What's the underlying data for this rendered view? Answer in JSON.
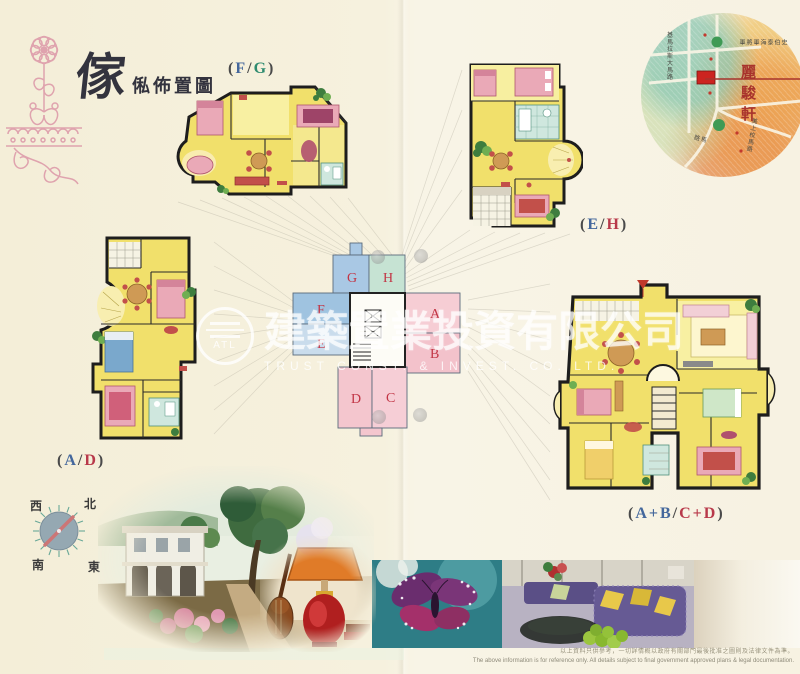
{
  "header": {
    "title_main": "傢",
    "title_sub": "俬佈置圖"
  },
  "location_map": {
    "name": "麗駿軒",
    "street_top": "基馬拉斯大馬路",
    "street_vertical": "史伯泰海軍將軍",
    "street_right": "美上校馬路",
    "street_diag": "馬路"
  },
  "floor_plans": {
    "fg": {
      "prefix": "(",
      "a": "F",
      "sep": "/",
      "b": "G",
      "suffix": ")"
    },
    "eh": {
      "prefix": "(",
      "a": "E",
      "sep": "/",
      "b": "H",
      "suffix": ")"
    },
    "ad": {
      "prefix": "(",
      "a": "A",
      "sep": "/",
      "b": "D",
      "suffix": ")"
    },
    "abcd": {
      "prefix": "(",
      "a": "A+B",
      "sep": "/",
      "b": "C+D",
      "suffix": ")"
    }
  },
  "keyplan": {
    "units": [
      "G",
      "H",
      "F",
      "E",
      "A",
      "B",
      "D",
      "C"
    ]
  },
  "compass": {
    "n": "北",
    "e": "東",
    "s": "南",
    "w": "西"
  },
  "watermark": {
    "logo": "ATL",
    "cn": "建築置業投資有限公司",
    "en": "TRUST  CONST.  &  INVEST.  CO.  LTD."
  },
  "footer": {
    "disclaimer_cn": "以上資料只供參考，一切詳情概以政府有關部門最後批准之圖則及法律文件為準。",
    "disclaimer_en": "The above information is for reference only. All details subject to final government approved plans & legal documentation."
  },
  "palette": {
    "page_bg": "#f6f1de",
    "plan_yellow": "#f1e06b",
    "wall_black": "#1d1d1d",
    "letter_blue": "#44679c",
    "letter_green": "#2e8b6f",
    "letter_red": "#b8394a",
    "keyplan_blue": "#a9c8e4",
    "keyplan_green": "#c6e3d3",
    "keyplan_pink": "#f5cad2",
    "map_name_red": "#a8332c",
    "ornament_pink": "#dfa3ae"
  }
}
